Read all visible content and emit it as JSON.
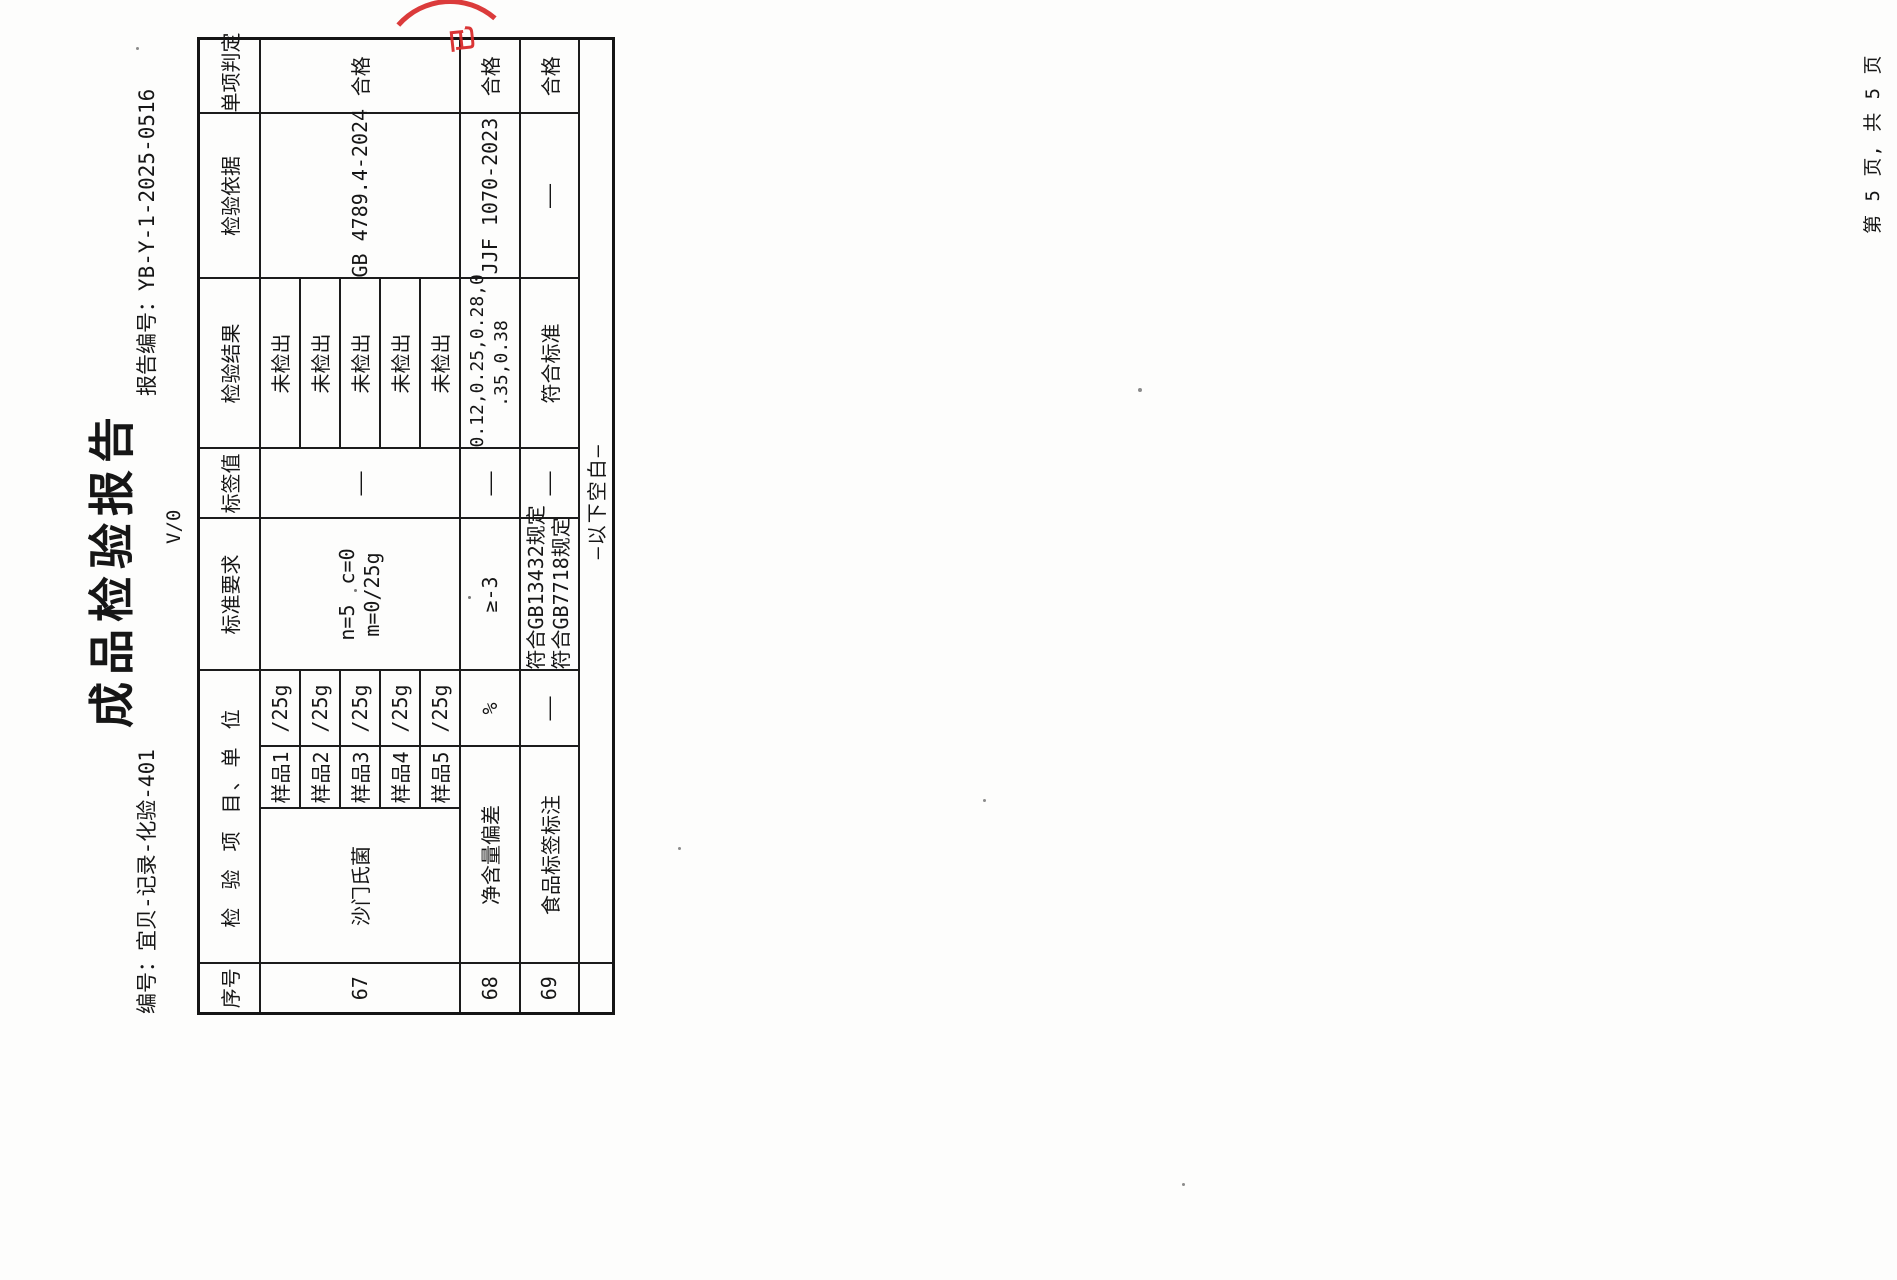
{
  "doc": {
    "title": "成品检验报告",
    "form_no": "编号：宜贝-记录-化验-401",
    "report_no": "报告编号：YB-Y-1-2025-0516",
    "version_mark": "V/0",
    "page_footer": "第 5 页, 共 5 页",
    "stamp_fragment": "已",
    "stamp_color": "#d92b2b"
  },
  "table": {
    "headers": {
      "no": "序号",
      "item_unit": "检 验 项 目、单 位",
      "standard": "标准要求",
      "label_value": "标签值",
      "result": "检验结果",
      "basis": "检验依据",
      "judgement": "单项判定"
    },
    "row67": {
      "no": "67",
      "item": "沙门氏菌",
      "samples": [
        {
          "name": "样品1",
          "unit": "/25g",
          "result": "未检出"
        },
        {
          "name": "样品2",
          "unit": "/25g",
          "result": "未检出"
        },
        {
          "name": "样品3",
          "unit": "/25g",
          "result": "未检出"
        },
        {
          "name": "样品4",
          "unit": "/25g",
          "result": "未检出"
        },
        {
          "name": "样品5",
          "unit": "/25g",
          "result": "未检出"
        }
      ],
      "standard_l1": "n=5　c=0",
      "standard_l2": "m=0/25g",
      "label_value": "——",
      "basis": "GB 4789.4-2024",
      "judgement": "合格"
    },
    "row68": {
      "no": "68",
      "item": "净含量偏差",
      "unit": "%",
      "standard": "≥-3",
      "label_value": "——",
      "result_l1": "0.12,0.25,0.28,0",
      "result_l2": ".35,0.38",
      "basis": "JJF 1070-2023",
      "judgement": "合格"
    },
    "row69": {
      "no": "69",
      "item": "食品标签标注",
      "unit": "——",
      "standard_l1": "符合GB13432规定",
      "standard_l2": "符合GB7718规定",
      "label_value": "——",
      "result": "符合标准",
      "basis": "——",
      "judgement": "合格"
    },
    "blank_row": "—以下空白—"
  }
}
